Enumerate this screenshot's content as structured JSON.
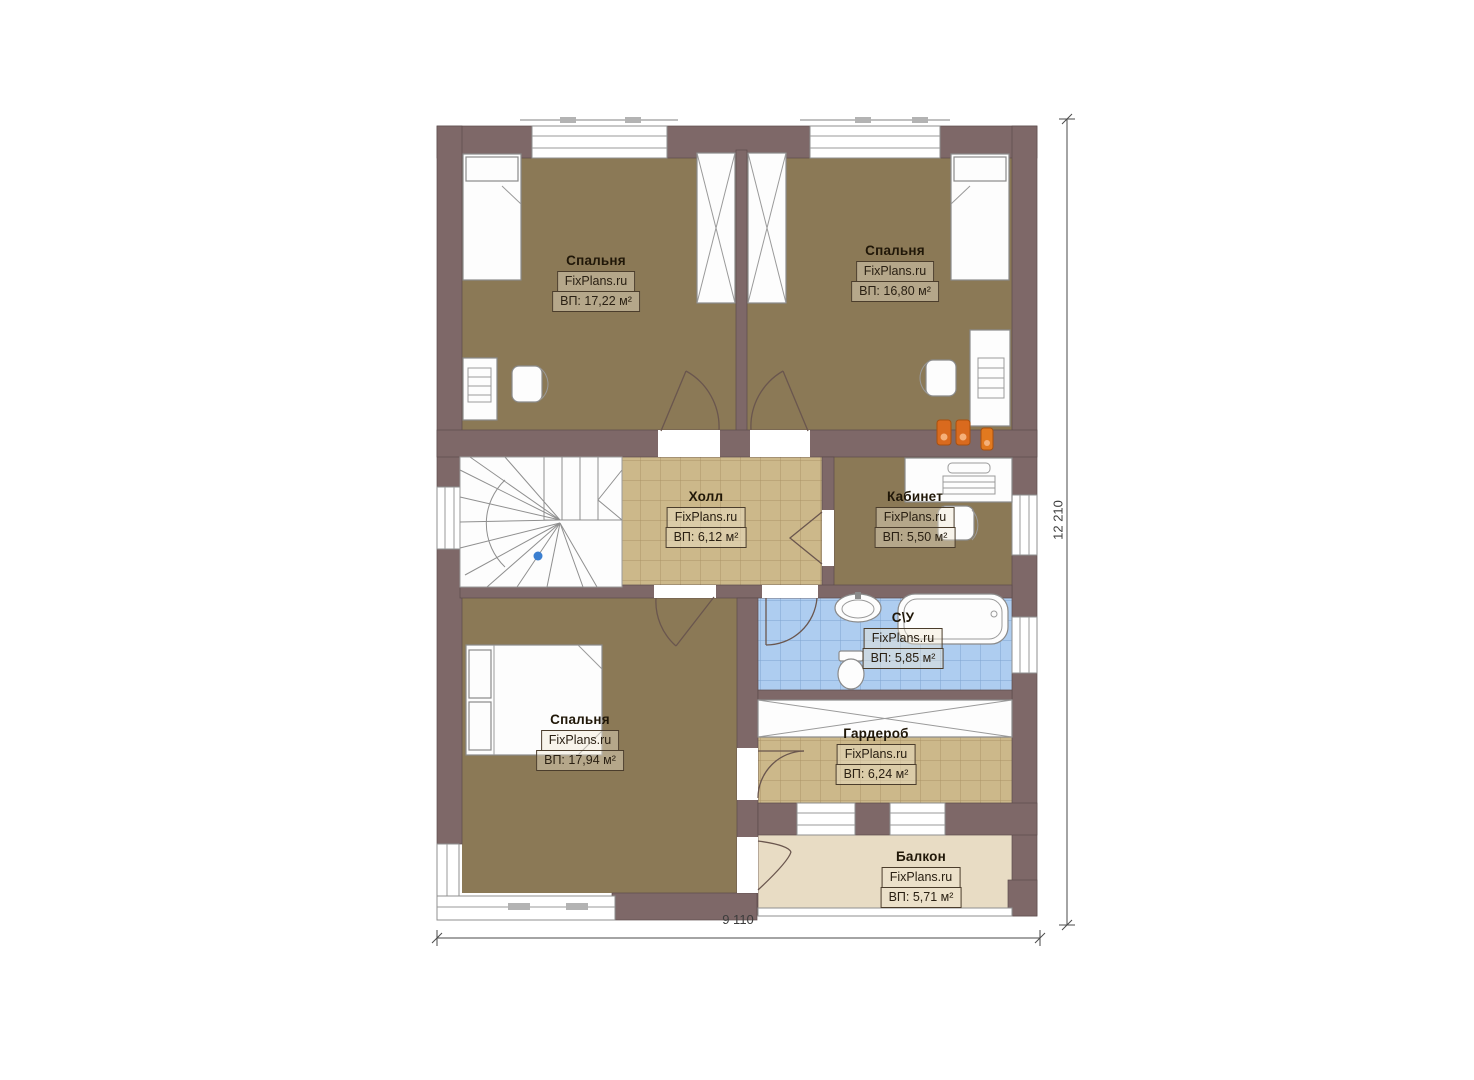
{
  "plan": {
    "title": "Floor plan — second floor",
    "watermark": "FixPlans.ru",
    "rooms": {
      "bedroom_tl": {
        "name": "Спальня",
        "brand": "FixPlans.ru",
        "area": "ВП: 17,22 м²"
      },
      "bedroom_tr": {
        "name": "Спальня",
        "brand": "FixPlans.ru",
        "area": "ВП: 16,80 м²"
      },
      "hall": {
        "name": "Холл",
        "brand": "FixPlans.ru",
        "area": "ВП: 6,12 м²"
      },
      "office": {
        "name": "Кабинет",
        "brand": "FixPlans.ru",
        "area": "ВП: 5,50 м²"
      },
      "bathroom": {
        "name": "С\\У",
        "brand": "FixPlans.ru",
        "area": "ВП: 5,85 м²"
      },
      "bedroom_b": {
        "name": "Спальня",
        "brand": "FixPlans.ru",
        "area": "ВП: 17,94 м²"
      },
      "wardrobe": {
        "name": "Гардероб",
        "brand": "FixPlans.ru",
        "area": "ВП: 6,24 м²"
      },
      "balcony": {
        "name": "Балкон",
        "brand": "FixPlans.ru",
        "area": "ВП: 5,71 м²"
      }
    },
    "dimensions": {
      "width_label": "9 110",
      "height_label": "12 210"
    },
    "colors": {
      "wall": "#7e6868",
      "bedroom_floor": "#8b7956",
      "tile_floor": "#ccb88a",
      "bath_tile": "#aecdf0",
      "balcony_floor": "#e8dcc4",
      "accent_orange": "#d96a1e",
      "marker_blue": "#3b7fd0"
    }
  }
}
